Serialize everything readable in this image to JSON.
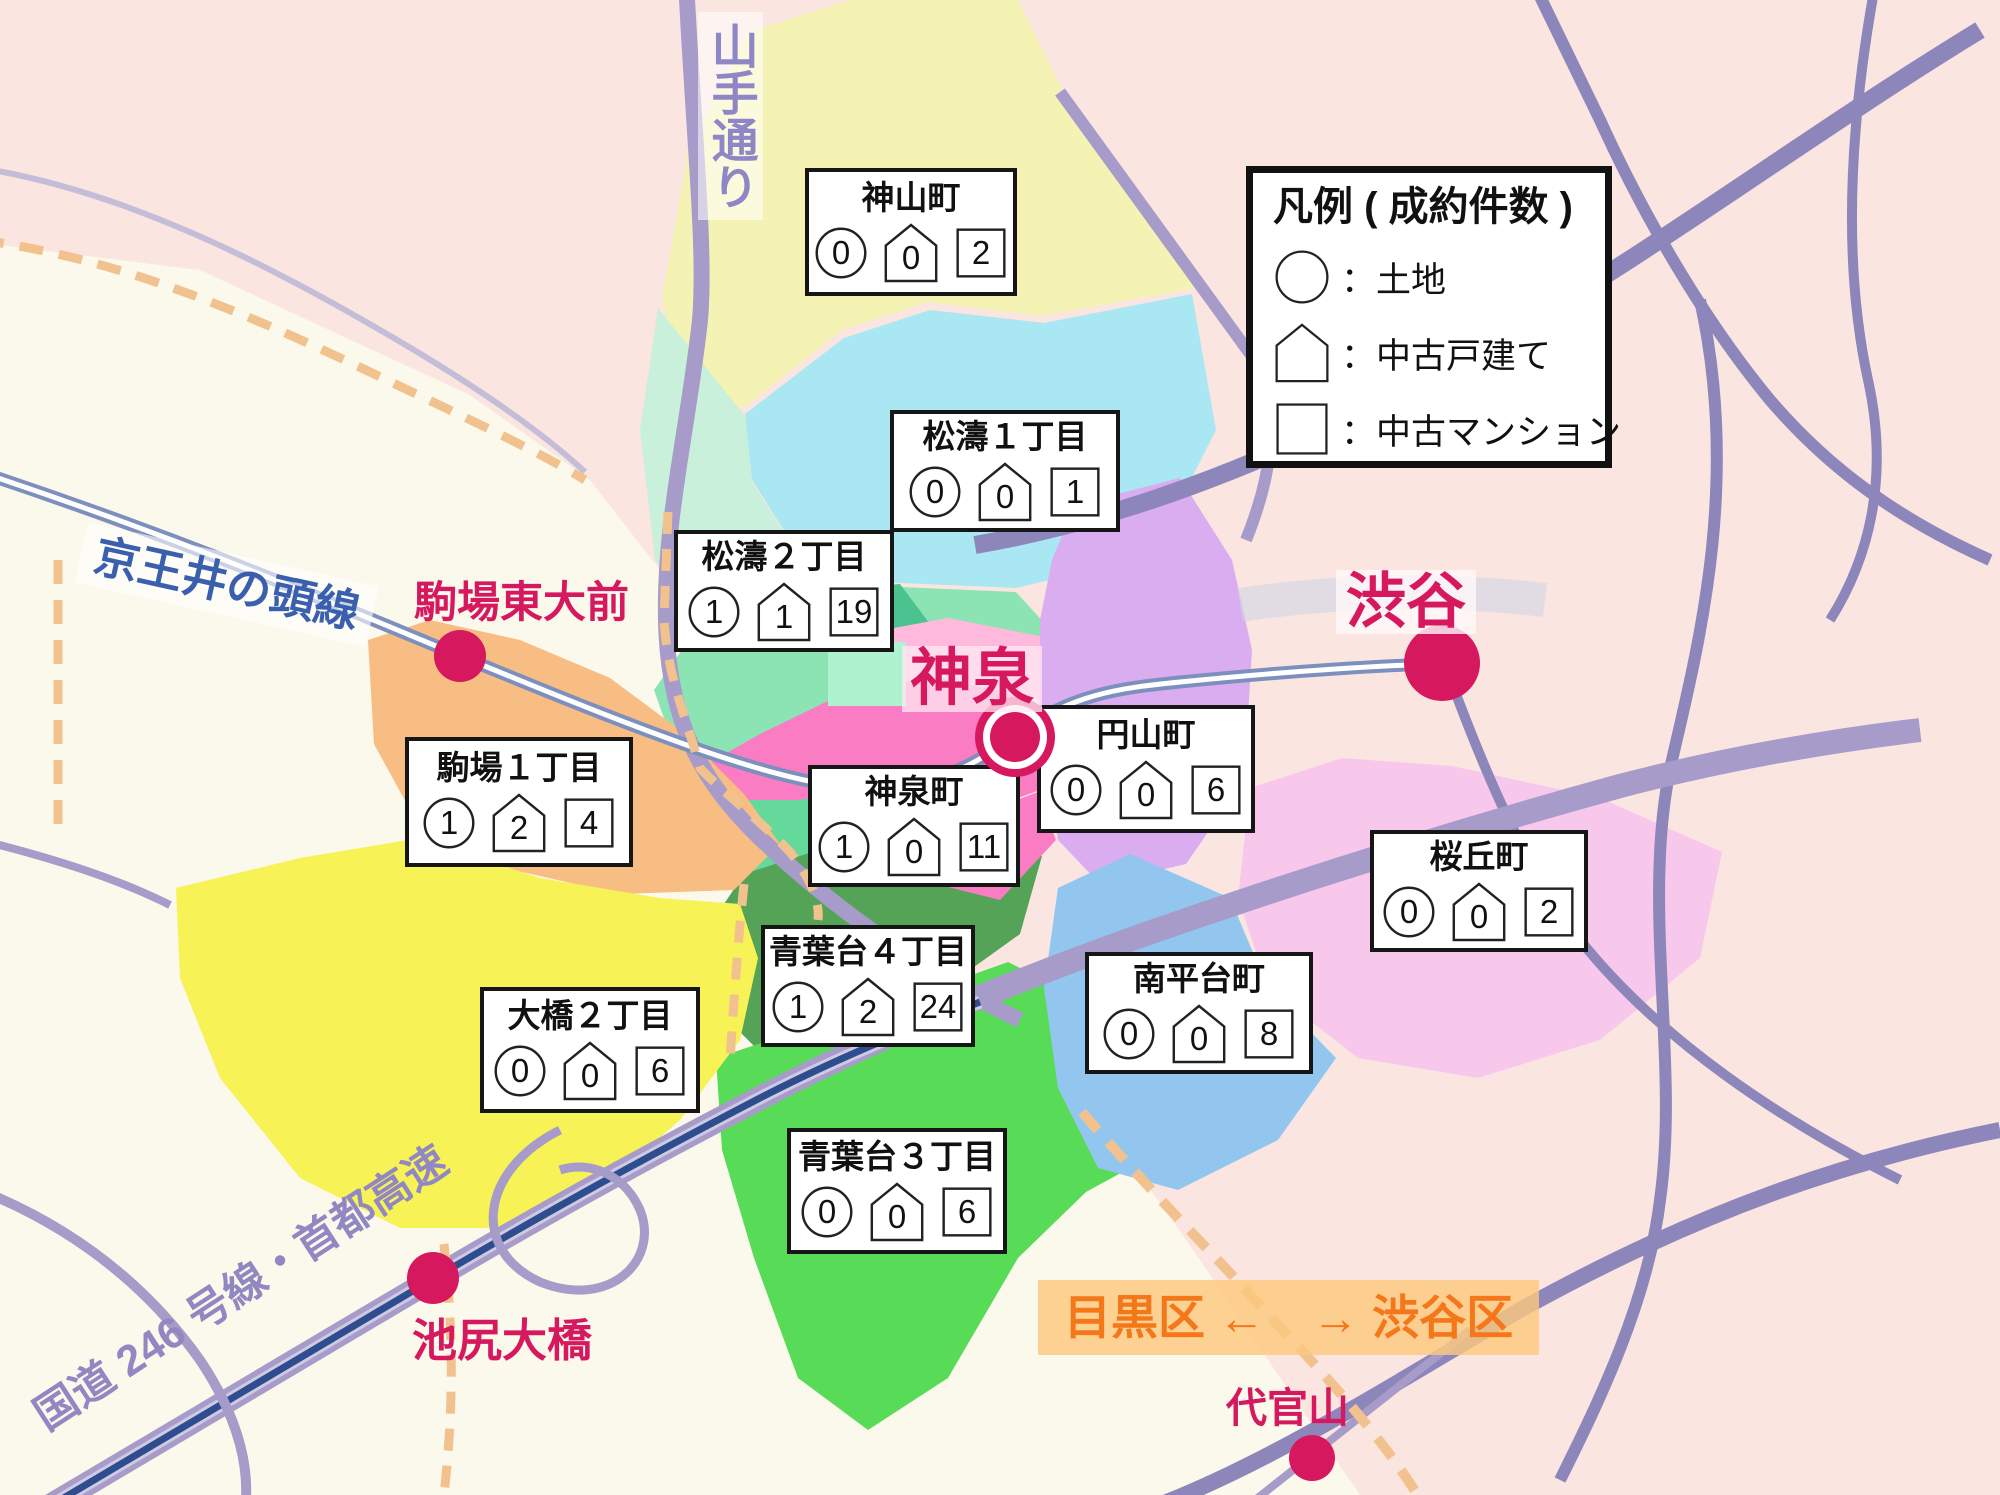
{
  "legend": {
    "title": "凡例 ( 成約件数 )",
    "land_label": "：土地",
    "house_label": "：中古戸建て",
    "mansion_label": "：中古マンション"
  },
  "areas": [
    {
      "name": "神山町",
      "land": "0",
      "house": "0",
      "mansion": "2",
      "color": "#f5f3b4"
    },
    {
      "name": "松濤１丁目",
      "land": "0",
      "house": "0",
      "mansion": "1",
      "color": "#a9e7f2"
    },
    {
      "name": "松濤２丁目",
      "land": "1",
      "house": "1",
      "mansion": "19",
      "color": "#8ce4b5"
    },
    {
      "name": "駒場１丁目",
      "land": "1",
      "house": "2",
      "mansion": "4",
      "color": "#f7bd83"
    },
    {
      "name": "神泉町",
      "land": "1",
      "house": "0",
      "mansion": "11",
      "color": "#fa7cc3"
    },
    {
      "name": "円山町",
      "land": "0",
      "house": "0",
      "mansion": "6",
      "color": "#d9adef"
    },
    {
      "name": "桜丘町",
      "land": "0",
      "house": "0",
      "mansion": "2",
      "color": "#f8c8ec"
    },
    {
      "name": "南平台町",
      "land": "0",
      "house": "0",
      "mansion": "8",
      "color": "#92c6ef"
    },
    {
      "name": "大橋２丁目",
      "land": "0",
      "house": "0",
      "mansion": "6",
      "color": "#f7f256"
    },
    {
      "name": "青葉台４丁目",
      "land": "1",
      "house": "2",
      "mansion": "24",
      "color": "#55a356"
    },
    {
      "name": "青葉台３丁目",
      "land": "0",
      "house": "0",
      "mansion": "6",
      "color": "#58dc58"
    }
  ],
  "stations": {
    "shibuya": "渋谷",
    "shinsen": "神泉",
    "komaba_todaimae": "駒場東大前",
    "ikejiri_ohashi": "池尻大橋",
    "daikanyama": "代官山"
  },
  "roads": {
    "yamate_dori": "山手通り",
    "keio_inokashira": "京王井の頭線",
    "route246": "国道 246 号線・首都高速"
  },
  "boundary_banner": "目黒区 ←　→ 渋谷区",
  "map_colors": {
    "shibuya_bg": "#fbe5e1",
    "meguro_bg": "#fbf8ec",
    "road_purple": "#a69bc9",
    "road_slate": "#8d86bb",
    "rail_blue": "#7d90bd",
    "rail_band": "#ccd6e8",
    "highway_mid": "#cfc9e4",
    "highway_core": "#2e4d8e",
    "boundary_dash": "#f2c28e",
    "grey_curve": "#c4bdd8",
    "station": "#d6185e",
    "mint_pale": "#c9f0da",
    "spring_green": "#65d89b",
    "stripe_teal": "#4cc291",
    "pink_light": "#ffb9dd",
    "mint_block": "#aef2cf",
    "banner_bg": "#fbc87e",
    "banner_text": "#f4781a",
    "blue_text": "#3a5fae",
    "purple_text": "#9187c2",
    "yamate_text": "#8f87c5"
  }
}
